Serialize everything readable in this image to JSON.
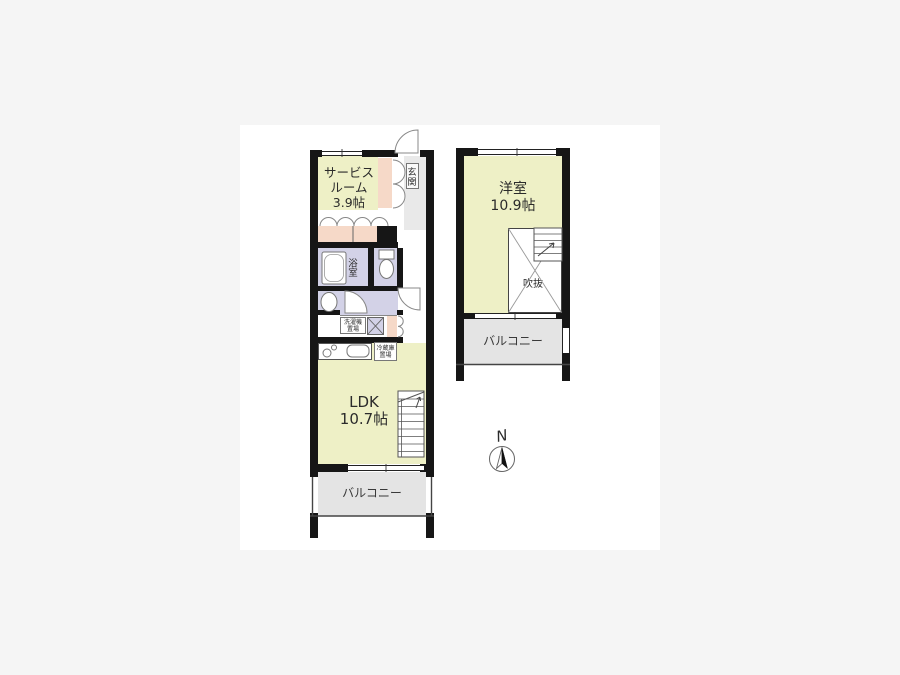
{
  "colors": {
    "page_bg": "#f5f5f5",
    "canvas": "#ffffff",
    "wall": "#161616",
    "room": "#eef0c6",
    "wet": "#d3d2e7",
    "closet": "#f6d9c8",
    "balcony": "#e4e4e4",
    "entrance": "#e9e9e9",
    "line": "#777777"
  },
  "floor1": {
    "service_room_label": "サービス\nルーム\n3.9帖",
    "entrance_label": "玄関",
    "bathroom_label": "浴室",
    "washer_label": "洗濯機\n置場",
    "fridge_label": "冷蔵庫\n置場",
    "ldk_label": "LDK\n10.7帖",
    "balcony_label": "バルコニー"
  },
  "floor2": {
    "room_label": "洋室\n10.9帖",
    "void_label": "吹抜",
    "balcony_label": "バルコニー"
  },
  "compass": {
    "north_label": "N"
  }
}
